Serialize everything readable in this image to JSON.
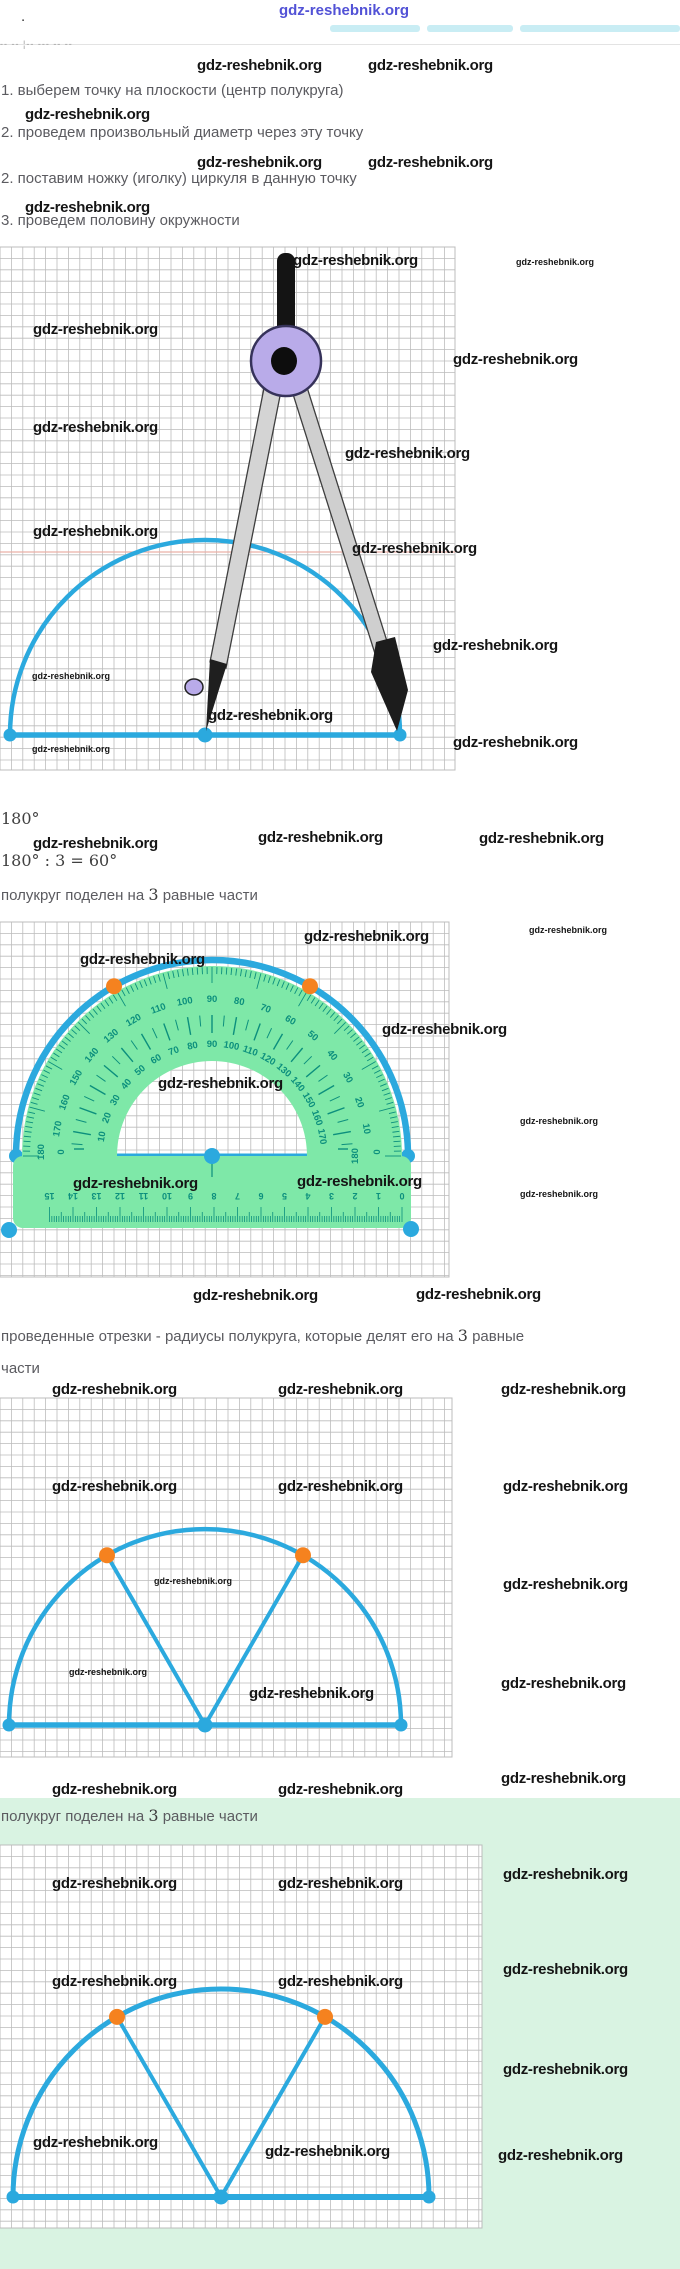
{
  "header": {
    "logo": "gdz-reshebnik.org",
    "dot": ".",
    "clipped_fragment": "-- -- ¦-- --- -- --"
  },
  "watermark_text": "gdz-reshebnik.org",
  "watermarks": [
    [
      197,
      57,
      "b"
    ],
    [
      368,
      57,
      "b"
    ],
    [
      25,
      106,
      "b"
    ],
    [
      197,
      154,
      "b"
    ],
    [
      368,
      154,
      "b"
    ],
    [
      25,
      199,
      "b"
    ],
    [
      293,
      252,
      "b"
    ],
    [
      516,
      257,
      "s"
    ],
    [
      33,
      321,
      "b"
    ],
    [
      453,
      351,
      "b"
    ],
    [
      33,
      419,
      "b"
    ],
    [
      345,
      445,
      "b"
    ],
    [
      33,
      523,
      "b"
    ],
    [
      352,
      540,
      "b"
    ],
    [
      433,
      637,
      "b"
    ],
    [
      32,
      671,
      "s"
    ],
    [
      208,
      707,
      "b"
    ],
    [
      453,
      734,
      "b"
    ],
    [
      32,
      744,
      "s"
    ],
    [
      33,
      835,
      "b"
    ],
    [
      258,
      829,
      "b"
    ],
    [
      479,
      830,
      "b"
    ],
    [
      304,
      928,
      "b"
    ],
    [
      529,
      925,
      "s"
    ],
    [
      80,
      951,
      "b"
    ],
    [
      382,
      1021,
      "b"
    ],
    [
      158,
      1075,
      "b"
    ],
    [
      520,
      1116,
      "s"
    ],
    [
      73,
      1175,
      "b"
    ],
    [
      297,
      1173,
      "b"
    ],
    [
      520,
      1189,
      "s"
    ],
    [
      193,
      1287,
      "b"
    ],
    [
      416,
      1286,
      "b"
    ],
    [
      52,
      1381,
      "b"
    ],
    [
      278,
      1381,
      "b"
    ],
    [
      501,
      1381,
      "b"
    ],
    [
      52,
      1478,
      "b"
    ],
    [
      278,
      1478,
      "b"
    ],
    [
      503,
      1478,
      "b"
    ],
    [
      154,
      1576,
      "s"
    ],
    [
      503,
      1576,
      "b"
    ],
    [
      69,
      1667,
      "s"
    ],
    [
      249,
      1685,
      "b"
    ],
    [
      501,
      1675,
      "b"
    ],
    [
      52,
      1781,
      "b"
    ],
    [
      278,
      1781,
      "b"
    ],
    [
      501,
      1770,
      "b"
    ],
    [
      52,
      1875,
      "b"
    ],
    [
      278,
      1875,
      "b"
    ],
    [
      503,
      1866,
      "b"
    ],
    [
      52,
      1973,
      "b"
    ],
    [
      278,
      1973,
      "b"
    ],
    [
      503,
      1961,
      "b"
    ],
    [
      503,
      2061,
      "b"
    ],
    [
      33,
      2134,
      "b"
    ],
    [
      265,
      2143,
      "b"
    ],
    [
      498,
      2147,
      "b"
    ]
  ],
  "steps": {
    "items": [
      "1. выберем точку на плоскости (центр полукруга)",
      "2. проведем произвольный диаметр через эту точку",
      "2. поставим ножку (иголку) циркуля в данную точку",
      "3. проведем половину окружности"
    ]
  },
  "formulas": {
    "line1": "180°",
    "line2": "180° : 3 = 60°"
  },
  "captions": {
    "divided_parts": [
      "полукруг поделен на ",
      "3",
      " равные части"
    ],
    "radii_line1_parts": [
      "проведенные отрезки - радиусы полукруга, которые делят его на ",
      "3",
      " равные"
    ],
    "radii_line2": "части",
    "divided2_parts": [
      "полукруг поделен на ",
      "3",
      " равные части"
    ]
  },
  "colors": {
    "blue": "#2ba9de",
    "orange": "#f5821f",
    "protractor_green": "#7ee8a8",
    "tick_teal": "#0c8f7d",
    "grid": "#bcbcbc",
    "green_bg": "#d9f3e2",
    "purple": "#b9abe9",
    "red_margin": "#e9b0a8"
  },
  "protractor_scales": {
    "angles": [
      10,
      20,
      30,
      40,
      50,
      60,
      70,
      80,
      90,
      100,
      110,
      120,
      130,
      140,
      150,
      160,
      170
    ],
    "outer": [
      "10",
      "20",
      "30",
      "40",
      "50",
      "60",
      "70",
      "80",
      "90",
      "100",
      "110",
      "120",
      "130",
      "140",
      "150",
      "160",
      "170"
    ],
    "inner": [
      "170",
      "160",
      "150",
      "140",
      "130",
      "120",
      "110",
      "100",
      "90",
      "80",
      "70",
      "60",
      "50",
      "40",
      "30",
      "20",
      "10"
    ],
    "left_edge_outer": "180",
    "left_edge_inner": "0",
    "right_edge_outer": "0",
    "right_edge_inner": "180"
  },
  "ruler": {
    "numbers": [
      "0",
      "1",
      "2",
      "3",
      "4",
      "5",
      "6",
      "7",
      "8",
      "9",
      "10",
      "11",
      "12",
      "13",
      "14",
      "15"
    ]
  },
  "figures": {
    "grid_cell": 11.4,
    "fig1": {
      "grid": {
        "x": 0,
        "y": 247,
        "w": 455,
        "h": 523
      },
      "red_line_y": 552,
      "semi": {
        "cx": 205,
        "cy": 735,
        "r": 195,
        "lw": 4.5
      },
      "compass": {
        "rod": {
          "x": 277,
          "y": 253,
          "w": 18,
          "h": 82
        },
        "joint": {
          "cx": 286,
          "cy": 361,
          "r": 35
        },
        "hub": {
          "cx": 284,
          "cy": 361,
          "rx": 13,
          "ry": 14
        },
        "left_leg": [
          [
            265,
            383
          ],
          [
            281,
            391
          ],
          [
            226,
            668
          ],
          [
            210,
            662
          ]
        ],
        "right_leg": [
          [
            292,
            391
          ],
          [
            306,
            384
          ],
          [
            391,
            654
          ],
          [
            377,
            660
          ]
        ],
        "needle": [
          [
            210,
            659
          ],
          [
            227,
            664
          ],
          [
            206,
            731
          ]
        ],
        "pencil": [
          [
            376,
            642
          ],
          [
            395,
            637
          ],
          [
            408,
            690
          ],
          [
            397,
            731
          ],
          [
            371,
            672
          ]
        ],
        "nut": {
          "cx": 194,
          "cy": 687,
          "rx": 9,
          "ry": 8
        }
      }
    },
    "fig2": {
      "grid": {
        "x": 0,
        "y": 922,
        "w": 449,
        "h": 355
      },
      "protractor": {
        "cx": 212,
        "cy": 1156,
        "arc_r": 196,
        "body_r": 190,
        "inner_r": 95,
        "base": {
          "x": 13,
          "y": 1156,
          "w": 398,
          "h": 72
        },
        "orange_angles": [
          60,
          120
        ],
        "corner_dots": [
          [
            9,
            1230
          ],
          [
            411,
            1229
          ]
        ],
        "ruler_x0": 402,
        "ruler_step": 23.5,
        "ruler_y": 1199,
        "ticks_y": 1222
      }
    },
    "fig3": {
      "grid": {
        "x": 0,
        "y": 1398,
        "w": 452,
        "h": 359
      },
      "semi": {
        "cx": 205,
        "cy": 1725,
        "r": 196,
        "lw": 4.5,
        "radii": true,
        "orange": [
          60,
          120
        ]
      }
    },
    "fig4": {
      "grid": {
        "x": 0,
        "y": 1845,
        "w": 482,
        "h": 383
      },
      "semi": {
        "cx": 221,
        "cy": 2197,
        "r": 208,
        "lw": 5,
        "radii": true,
        "orange": [
          60,
          120
        ]
      }
    }
  }
}
